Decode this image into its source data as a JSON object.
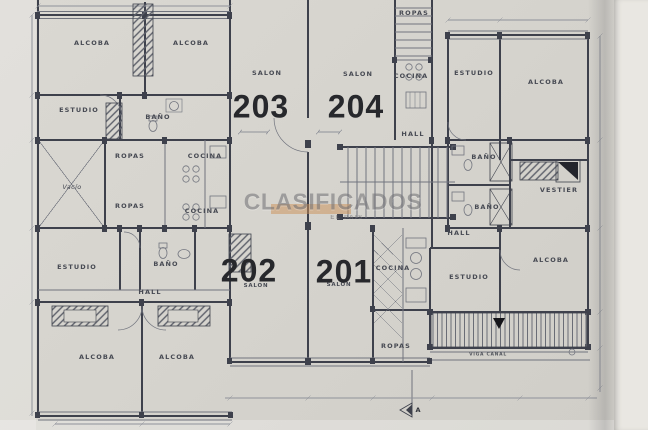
{
  "watermark": {
    "text": "CLASIFICADOS",
    "subtext": "EL PAIS",
    "bar_color": "#cc8f55"
  },
  "units": [
    {
      "number": "203"
    },
    {
      "number": "204"
    },
    {
      "number": "202"
    },
    {
      "number": "201"
    }
  ],
  "rooms": [
    {
      "text": "ALCOBA"
    },
    {
      "text": "ALCOBA"
    },
    {
      "text": "ESTUDIO"
    },
    {
      "text": "BAÑO"
    },
    {
      "text": "ROPAS"
    },
    {
      "text": "COCINA"
    },
    {
      "text": "Vacío"
    },
    {
      "text": "ROPAS"
    },
    {
      "text": "COCINA"
    },
    {
      "text": "SALON"
    },
    {
      "text": "SALON"
    },
    {
      "text": "ROPAS"
    },
    {
      "text": "COCINA"
    },
    {
      "text": "HALL"
    },
    {
      "text": "ESTUDIO"
    },
    {
      "text": "ALCOBA"
    },
    {
      "text": "BAÑO"
    },
    {
      "text": "BAÑO"
    },
    {
      "text": "VESTIER"
    },
    {
      "text": "HALL"
    },
    {
      "text": "ALCOBA"
    },
    {
      "text": "ESTUDIO"
    },
    {
      "text": "COCINA"
    },
    {
      "text": "ROPAS"
    },
    {
      "text": "ESTUDIO"
    },
    {
      "text": "BAÑO"
    },
    {
      "text": "HALL"
    },
    {
      "text": "ALCOBA"
    },
    {
      "text": "ALCOBA"
    },
    {
      "text": "SALON"
    },
    {
      "text": "SALON"
    }
  ],
  "annotations": {
    "balcony_note": "VIGA CANAL",
    "section_marker": "A"
  },
  "colors": {
    "paper": "#d6d4ce",
    "paper-edge": "#e9e7e2",
    "ink": "#3e414c",
    "line": "#71747e",
    "dim": "#8f929a",
    "digits": "#27282c",
    "wm": "#707074",
    "wm-bar": "#cc8f55"
  }
}
